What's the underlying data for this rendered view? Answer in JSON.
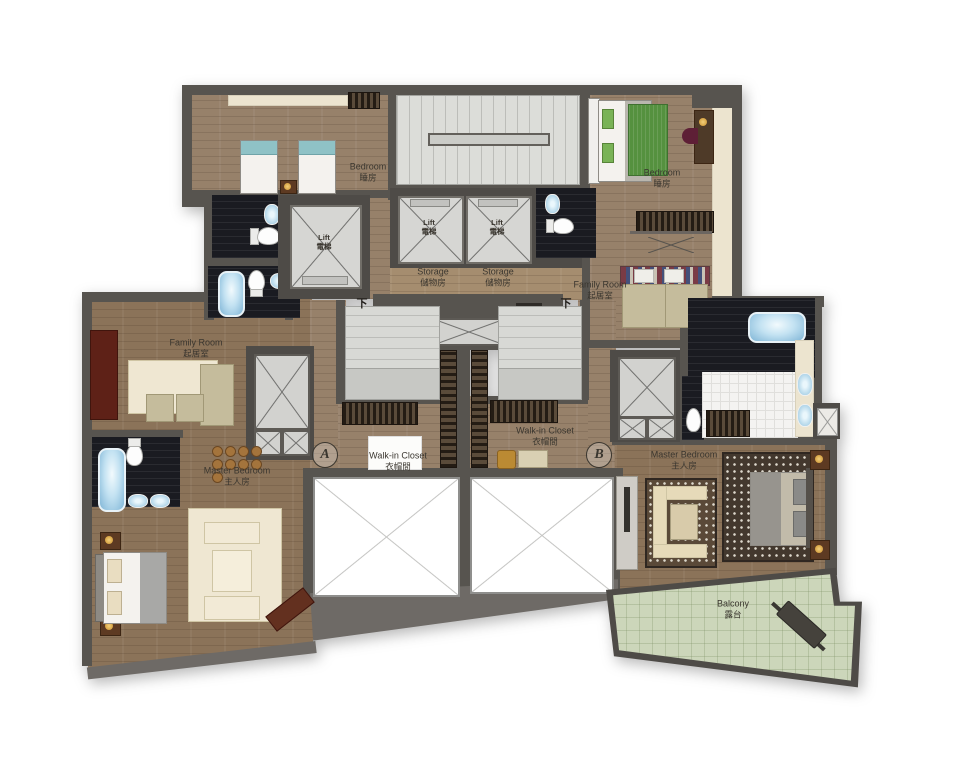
{
  "plan": {
    "type": "residential-floor-plan",
    "rooms": {
      "bedroom_tl": {
        "en": "Bedroom",
        "zh": "睡房"
      },
      "bedroom_tr": {
        "en": "Bedroom",
        "zh": "睡房"
      },
      "lift_left": {
        "en": "Lift",
        "zh": "電梯"
      },
      "lift_c1": {
        "en": "Lift",
        "zh": "電梯"
      },
      "lift_c2": {
        "en": "Lift",
        "zh": "電梯"
      },
      "storage_1": {
        "en": "Storage",
        "zh": "儲物房"
      },
      "storage_2": {
        "en": "Storage",
        "zh": "儲物房"
      },
      "family_left": {
        "en": "Family Room",
        "zh": "起居室"
      },
      "family_right": {
        "en": "Family Room",
        "zh": "起居室"
      },
      "closet_left": {
        "en": "Walk-in Closet",
        "zh": "衣帽間"
      },
      "closet_right": {
        "en": "Walk-in Closet",
        "zh": "衣帽間"
      },
      "master_left": {
        "en": "Master Bedroom",
        "zh": "主人房"
      },
      "master_right": {
        "en": "Master Bedroom",
        "zh": "主人房"
      },
      "balcony": {
        "en": "Balcony",
        "zh": "露台"
      }
    },
    "markers": {
      "unit_a": "A",
      "unit_b": "B",
      "down_left": "下",
      "down_right": "下"
    },
    "colors": {
      "wall": "#57544f",
      "wood_floor": "#97816a",
      "stair_grey": "#dcddd9",
      "bath_dark": "#1a1b21",
      "balcony_green": "#ccd6ba",
      "tub_blue": "#7fb5d6",
      "void_white": "#ffffff"
    }
  }
}
